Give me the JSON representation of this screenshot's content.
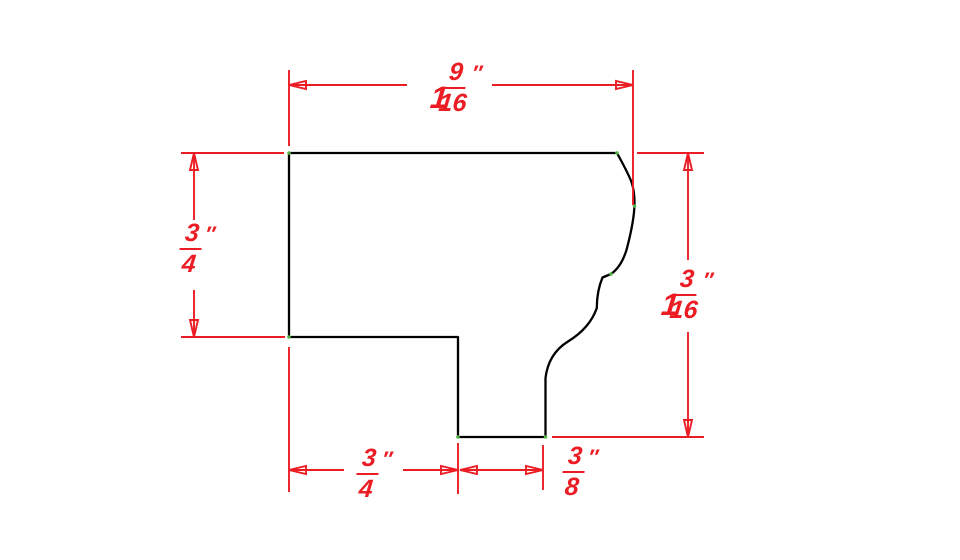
{
  "drawing": {
    "kind": "profile-cross-section-with-dimensions",
    "units_symbol": "″",
    "colors": {
      "dimension_red": "#EC1C24",
      "outline_black": "#000000",
      "vertex_green": "#55B24B",
      "background": "#FFFFFF"
    },
    "dimensions": {
      "top_width": {
        "whole": "1",
        "numerator": "9",
        "denominator": "16",
        "unit": "″",
        "full_label": "1 9/16\""
      },
      "left_height": {
        "whole": "",
        "numerator": "3",
        "denominator": "4",
        "unit": "″",
        "full_label": "3/4\""
      },
      "right_height": {
        "whole": "1",
        "numerator": "3",
        "denominator": "16",
        "unit": "″",
        "full_label": "1 3/16\""
      },
      "bottom_left_width": {
        "whole": "",
        "numerator": "3",
        "denominator": "4",
        "unit": "″",
        "full_label": "3/4\""
      },
      "bottom_right_width": {
        "whole": "",
        "numerator": "3",
        "denominator": "8",
        "unit": "″",
        "full_label": "3/8\""
      }
    }
  }
}
